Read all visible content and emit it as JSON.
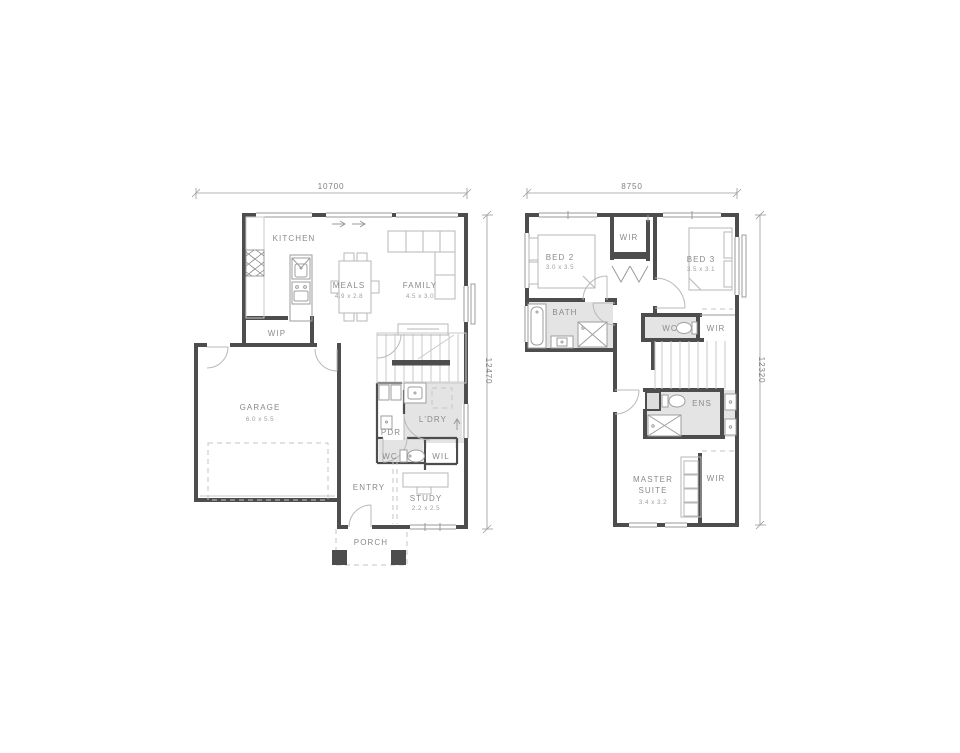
{
  "colors": {
    "background": "#ffffff",
    "wall": "#4d4d4d",
    "room_shading": "#e4e4e4",
    "furniture_line": "#b7b7b7",
    "label_text": "#8a8a8a",
    "dimension_text": "#818181"
  },
  "ground_floor": {
    "width_dim": "10700",
    "height_dim": "12470",
    "rooms": {
      "kitchen": {
        "label": "KITCHEN"
      },
      "meals": {
        "label": "MEALS",
        "size": "4.9 x 2.8"
      },
      "family": {
        "label": "FAMILY",
        "size": "4.5 x 3.0"
      },
      "wip": {
        "label": "WIP"
      },
      "garage": {
        "label": "GARAGE",
        "size": "6.0 x 5.5"
      },
      "pdr": {
        "label": "PDR"
      },
      "ldry": {
        "label": "L'DRY"
      },
      "wc": {
        "label": "WC"
      },
      "wil": {
        "label": "WIL"
      },
      "entry": {
        "label": "ENTRY"
      },
      "study": {
        "label": "STUDY",
        "size": "2.2 x 2.5"
      },
      "porch": {
        "label": "PORCH"
      }
    }
  },
  "first_floor": {
    "width_dim": "8750",
    "height_dim": "12320",
    "rooms": {
      "bed2": {
        "label": "BED 2",
        "size": "3.0 x 3.5"
      },
      "wir_hall": {
        "label": "WIR"
      },
      "bed3": {
        "label": "BED 3",
        "size": "3.5 x 3.1"
      },
      "bath": {
        "label": "BATH"
      },
      "wc": {
        "label": "WC"
      },
      "wir_bed3": {
        "label": "WIR"
      },
      "ens": {
        "label": "ENS"
      },
      "master": {
        "label_line1": "MASTER",
        "label_line2": "SUITE",
        "size": "3.4 x 3.2"
      },
      "wir_master": {
        "label": "WIR"
      }
    }
  }
}
